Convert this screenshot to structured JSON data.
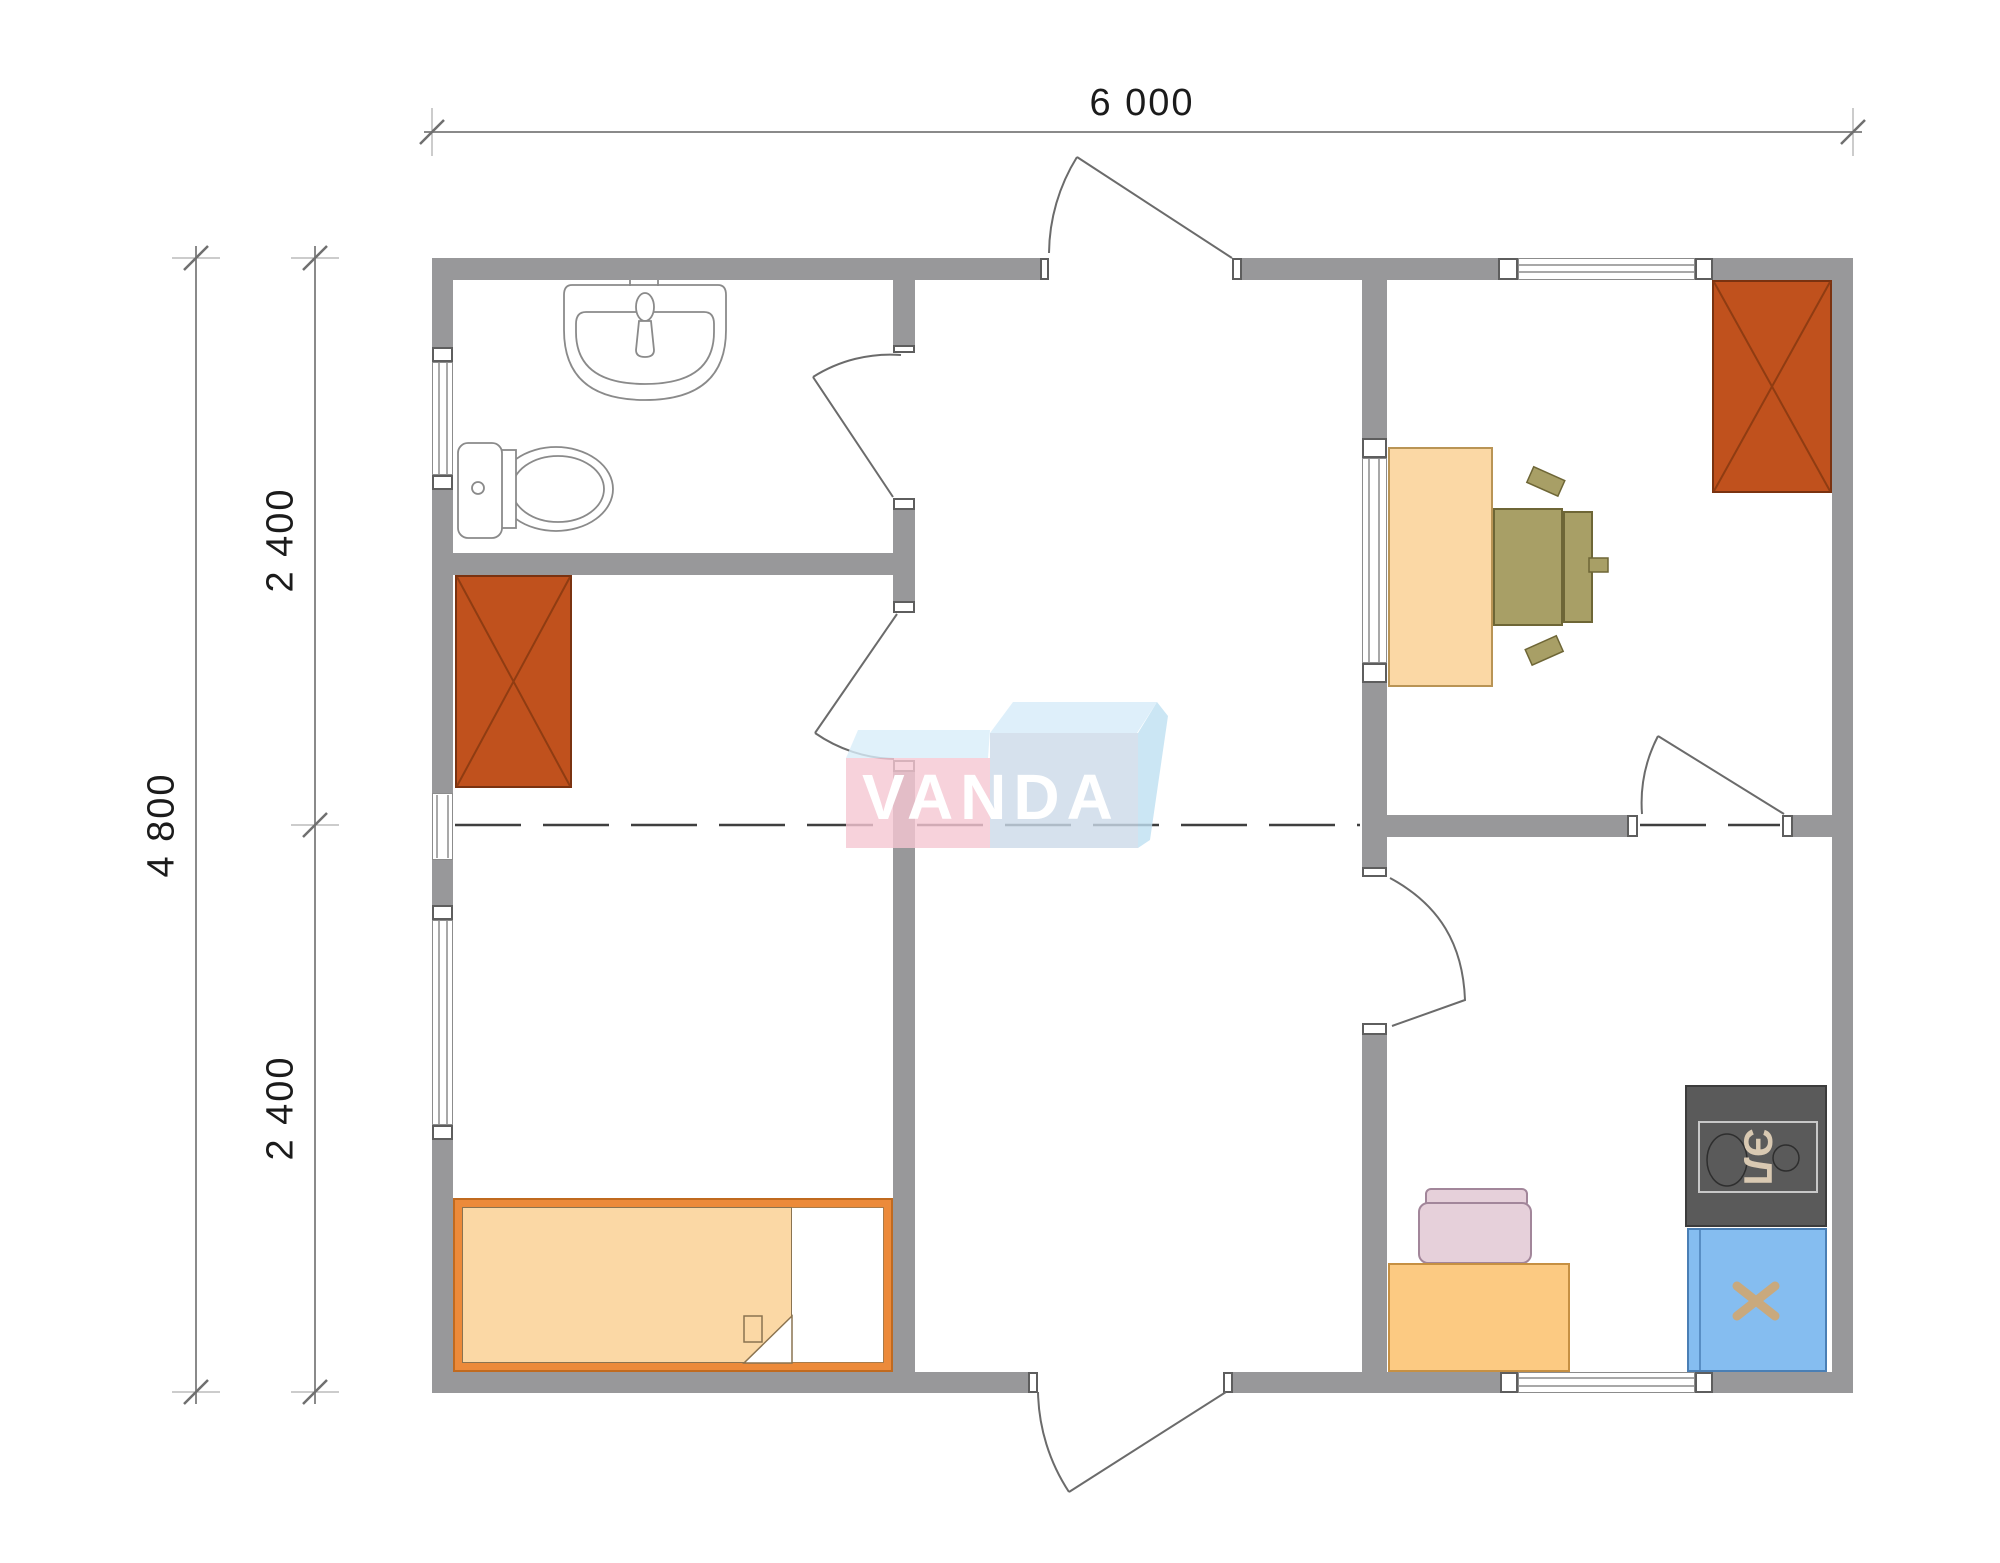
{
  "drawing": {
    "type": "modular-house-floor-plan",
    "watermark": "VANDA"
  },
  "dimensions": {
    "width_label": "6 000",
    "height_total_label": "4 800",
    "height_upper_label": "2 400",
    "height_lower_label": "2 400"
  },
  "logo": {
    "text": "VANDA"
  },
  "labels": {
    "stove": "ЭЛ"
  },
  "furniture_icons": [
    "sink-icon",
    "toilet-icon",
    "wardrobe-icon",
    "wardrobe-icon",
    "bed-icon",
    "desk-icon",
    "office-chair-icon",
    "stove-icon",
    "kitchen-sink-cabinet-icon",
    "counter-icon",
    "chair-icon"
  ],
  "colors": {
    "wall_gray": "#98989a",
    "wardrobe_brown": "#c0511d",
    "bed_frame_orange": "#ec8a3a",
    "mattress_peach": "#fbd8a5",
    "desk_peach": "#fbd8a5",
    "counter_peach": "#fcca82",
    "office_chair_olive": "#a89f66",
    "kitchen_chair_pink": "#e6d0da",
    "stove_dark": "#5a5a5a",
    "sink_cabinet_blue": "#85bdf0",
    "logo_pink": "#f6c7d3",
    "logo_blue_front": "#ccdae9",
    "logo_sky_top": "#d6ecf9",
    "module_joint_dash": "#3f3f3f"
  }
}
